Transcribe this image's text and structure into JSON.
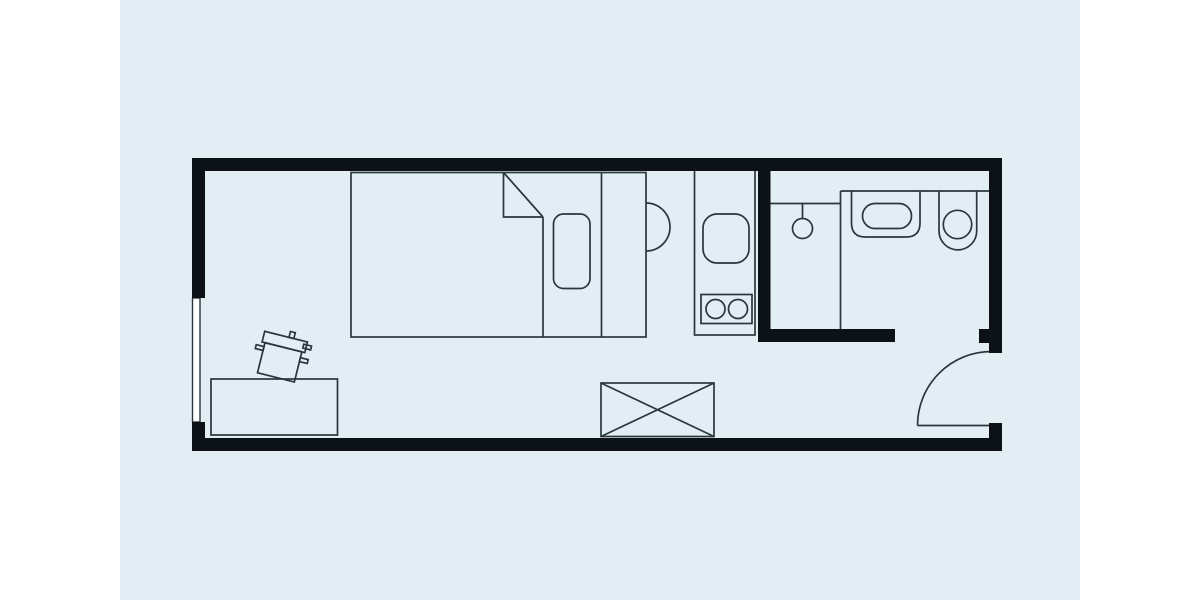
{
  "canvas": {
    "width": 1200,
    "height": 600,
    "background": "#ffffff",
    "panel": {
      "x": 120,
      "y": 0,
      "w": 960,
      "h": 600,
      "fill": "#e3eef4"
    }
  },
  "style": {
    "wall_color": "#0d1216",
    "line_color": "#2a363e",
    "window_fill": "#ffffff",
    "line_width": 1.7,
    "window_line_width": 1.4
  },
  "shapes": [
    {
      "name": "bed-outline",
      "type": "rect",
      "x": 351,
      "y": 172.5,
      "w": 295,
      "h": 164.5
    },
    {
      "name": "bed-blanket-fold",
      "type": "path",
      "d": "M503.5 172.5 L503.5 217 L543 217"
    },
    {
      "name": "bed-blanket-diagonal",
      "type": "line",
      "x1": 503.5,
      "y1": 172.5,
      "x2": 543,
      "y2": 217
    },
    {
      "name": "bed-blanket-edge",
      "type": "line",
      "x1": 543,
      "y1": 217,
      "x2": 543,
      "y2": 337
    },
    {
      "name": "bed-pillow",
      "type": "rect",
      "x": 553.5,
      "y": 214,
      "w": 36.5,
      "h": 74.5,
      "rx": 10
    },
    {
      "name": "bed-frame-line",
      "type": "line",
      "x1": 601.5,
      "y1": 172.5,
      "x2": 601.5,
      "y2": 337
    },
    {
      "name": "bedside-semicircle-table",
      "type": "path",
      "d": "M646 203 A24 24 0 0 1 646 251"
    },
    {
      "name": "desk",
      "type": "rect",
      "x": 211,
      "y": 379,
      "w": 126.5,
      "h": 56
    },
    {
      "name": "chair-backrest",
      "type": "rect",
      "x": -22,
      "y": -21,
      "w": 44,
      "h": 11,
      "transform": "translate(281 357) rotate(14)"
    },
    {
      "name": "chair-seat",
      "type": "rect",
      "x": -19,
      "y": -10,
      "w": 38,
      "h": 31,
      "transform": "translate(281 357) rotate(14)"
    },
    {
      "name": "chair-stub-top",
      "type": "rect",
      "x": 3,
      "y": -27,
      "w": 5,
      "h": 6,
      "transform": "translate(281 357) rotate(14)"
    },
    {
      "name": "chair-stub-left",
      "type": "rect",
      "x": -27,
      "y": -6,
      "w": 8,
      "h": 4,
      "transform": "translate(281 357) rotate(14)"
    },
    {
      "name": "chair-stub-right-upper",
      "type": "rect",
      "x": 19,
      "y": -18,
      "w": 8,
      "h": 4,
      "transform": "translate(281 357) rotate(14)"
    },
    {
      "name": "chair-stub-right-lower",
      "type": "rect",
      "x": 19,
      "y": -4,
      "w": 8,
      "h": 4,
      "transform": "translate(281 357) rotate(14)"
    },
    {
      "name": "kitchen-counter",
      "type": "rect",
      "x": 694.5,
      "y": 169,
      "w": 60.5,
      "h": 166
    },
    {
      "name": "kitchen-sink",
      "type": "rect",
      "x": 703,
      "y": 214,
      "w": 46,
      "h": 49,
      "rx": 14
    },
    {
      "name": "stove",
      "type": "rect",
      "x": 701,
      "y": 294.5,
      "w": 51,
      "h": 29
    },
    {
      "name": "stove-burner-left",
      "type": "circle",
      "cx": 715.5,
      "cy": 309,
      "r": 9.5
    },
    {
      "name": "stove-burner-right",
      "type": "circle",
      "cx": 738,
      "cy": 309,
      "r": 9.5
    },
    {
      "name": "shower-line",
      "type": "line",
      "x1": 770.5,
      "y1": 203.5,
      "x2": 840.5,
      "y2": 203.5
    },
    {
      "name": "shower-stem",
      "type": "line",
      "x1": 802.5,
      "y1": 203.5,
      "x2": 802.5,
      "y2": 218.5
    },
    {
      "name": "shower-head",
      "type": "circle",
      "cx": 802.5,
      "cy": 228.5,
      "r": 10
    },
    {
      "name": "bathroom-divider-line",
      "type": "line",
      "x1": 840.5,
      "y1": 191,
      "x2": 840.5,
      "y2": 329
    },
    {
      "name": "bathroom-counter-line",
      "type": "line",
      "x1": 840.5,
      "y1": 191,
      "x2": 989,
      "y2": 191
    },
    {
      "name": "bathroom-sink-basin",
      "type": "path",
      "d": "M851.5 191 L851.5 223 Q851.5 237 865.5 237 L906 237 Q920 237 920 223 L920 191"
    },
    {
      "name": "bathroom-sink-bowl",
      "type": "rect",
      "x": 862.5,
      "y": 203.5,
      "w": 49,
      "h": 25,
      "rx": 12.5
    },
    {
      "name": "toilet-outline",
      "type": "path",
      "d": "M939 191 L939 231 A18.85 18.85 0 0 0 976.7 231 L976.7 191"
    },
    {
      "name": "toilet-bowl",
      "type": "circle",
      "cx": 957.5,
      "cy": 224.5,
      "r": 14.2
    },
    {
      "name": "crossed-cabinet",
      "type": "rect",
      "x": 601,
      "y": 383,
      "w": 113,
      "h": 53.5
    },
    {
      "name": "crossed-cabinet-diagonal-1",
      "type": "line",
      "x1": 601,
      "y1": 383,
      "x2": 714,
      "y2": 436.5
    },
    {
      "name": "crossed-cabinet-diagonal-2",
      "type": "line",
      "x1": 714,
      "y1": 383,
      "x2": 601,
      "y2": 436.5
    },
    {
      "name": "entry-door-leaf",
      "type": "line",
      "x1": 917.5,
      "y1": 425.5,
      "x2": 991,
      "y2": 425.5
    },
    {
      "name": "entry-door-swing-arc",
      "type": "path",
      "d": "M917.5 425.5 A74 74 0 0 1 991.5 351.5"
    },
    {
      "name": "window",
      "type": "rect",
      "x": 192.5,
      "y": 298,
      "w": 7.5,
      "h": 124,
      "paint": "window"
    },
    {
      "name": "wall-top",
      "type": "rect",
      "x": 192,
      "y": 158,
      "w": 810,
      "h": 13,
      "paint": "wall"
    },
    {
      "name": "wall-left-upper",
      "type": "rect",
      "x": 192,
      "y": 158,
      "w": 13,
      "h": 140,
      "paint": "wall"
    },
    {
      "name": "wall-left-lower",
      "type": "rect",
      "x": 192,
      "y": 422,
      "w": 13,
      "h": 29,
      "paint": "wall"
    },
    {
      "name": "wall-bottom",
      "type": "rect",
      "x": 192,
      "y": 438,
      "w": 810,
      "h": 13,
      "paint": "wall"
    },
    {
      "name": "wall-right-upper",
      "type": "rect",
      "x": 989,
      "y": 158,
      "w": 13,
      "h": 195,
      "paint": "wall"
    },
    {
      "name": "wall-right-lower",
      "type": "rect",
      "x": 989,
      "y": 423,
      "w": 13,
      "h": 28,
      "paint": "wall"
    },
    {
      "name": "wall-bathroom-partition",
      "type": "rect",
      "x": 758,
      "y": 158,
      "w": 12.5,
      "h": 184,
      "paint": "wall"
    },
    {
      "name": "wall-bathroom-bottom",
      "type": "rect",
      "x": 758,
      "y": 329,
      "w": 137,
      "h": 13,
      "paint": "wall"
    },
    {
      "name": "wall-entry-jamb",
      "type": "rect",
      "x": 979,
      "y": 329,
      "w": 14,
      "h": 14,
      "paint": "wall"
    }
  ]
}
